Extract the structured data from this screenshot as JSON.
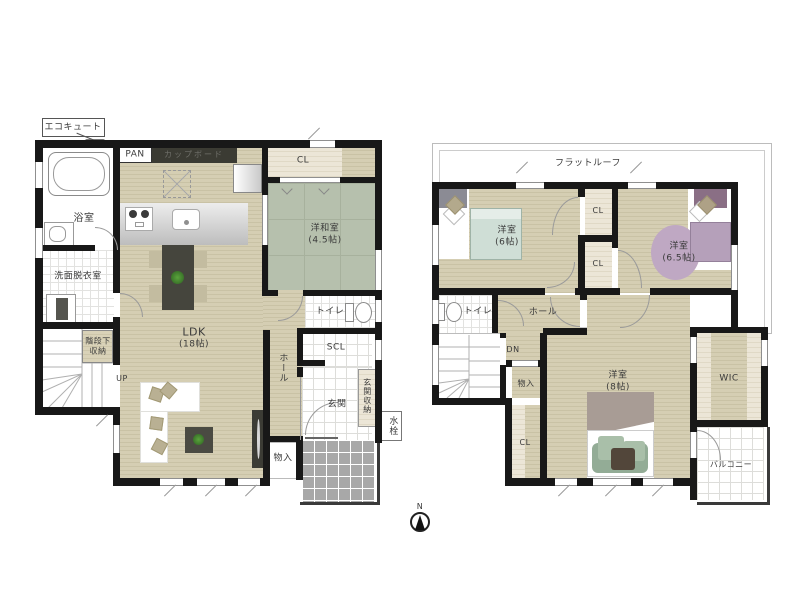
{
  "compass": {
    "north_label": "N"
  },
  "colors": {
    "wall": "#181818",
    "wood_floor": "#d5ceb3",
    "tatami": "#b6c0ad",
    "closet_cream": "#ece6d7",
    "porch_gray": "#a8a8a8",
    "bed_green": "#cfded6",
    "bed_purple": "#b5a0ba",
    "rug_purple": "#bfa8c3",
    "cushion_green": "#93ac96",
    "furniture_dark": "#3c3c35"
  },
  "floor1": {
    "ecocute_label": "エコキュート",
    "bath_label": "浴室",
    "washroom_label": "洗面脱衣室",
    "pan_label": "PAN",
    "cupboard_label": "カップボード",
    "closet_label": "CL",
    "washitsu_label": "洋和室",
    "washitsu_size": "(4.5帖)",
    "toilet_label": "トイレ",
    "ldk_label": "LDK",
    "ldk_size": "(18帖)",
    "stair_storage_label": "階段下収納",
    "up_label": "UP",
    "hall_label": "ホール",
    "scl_label": "SCL",
    "entrance_label": "玄関",
    "entrance_storage_label": "玄関収納",
    "storage_label": "物入",
    "water_tap_label": "水栓"
  },
  "floor2": {
    "flat_roof_label": "フラットルーフ",
    "bedroom6_label": "洋室",
    "bedroom6_size": "(6帖)",
    "closet1_label": "CL",
    "closet2_label": "CL",
    "bedroom65_label": "洋室",
    "bedroom65_size": "(6.5帖)",
    "toilet_label": "トイレ",
    "hall_label": "ホール",
    "down_label": "DN",
    "storage_label": "物入",
    "closet3_label": "CL",
    "bedroom8_label": "洋室",
    "bedroom8_size": "(8帖)",
    "wic_label": "WIC",
    "balcony_label": "バルコニー"
  }
}
